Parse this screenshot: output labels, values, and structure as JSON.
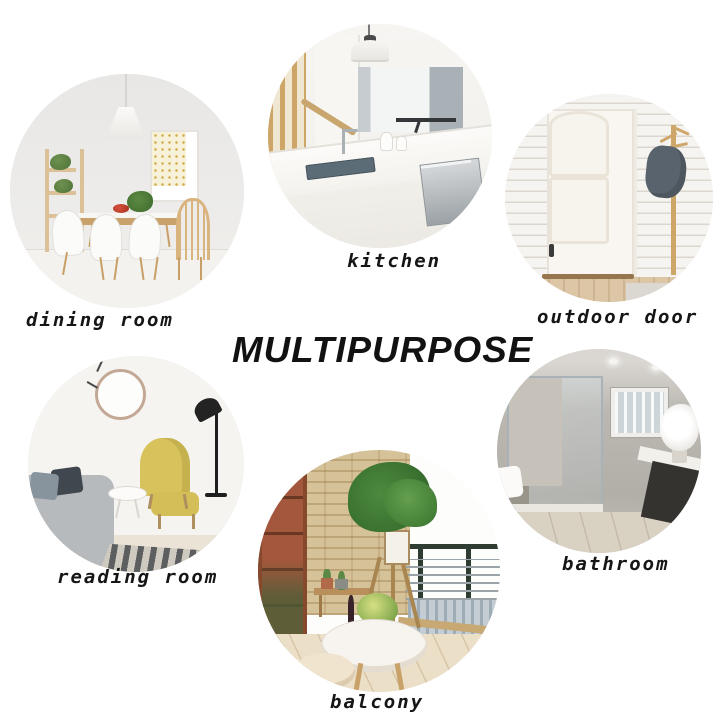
{
  "title": "MULTIPURPOSE",
  "rooms": [
    {
      "label": "dining room"
    },
    {
      "label": "kitchen"
    },
    {
      "label": "outdoor door"
    },
    {
      "label": "reading room"
    },
    {
      "label": "balcony"
    },
    {
      "label": "bathroom"
    }
  ],
  "colors": {
    "background": "#ffffff",
    "text": "#161616",
    "wood": "#c9a26b",
    "gold_art": "#d2ae4e",
    "yellow_chair": "#d7c25b",
    "stone_wall": "#d6c298",
    "brick": "#a3573c",
    "plant_green": "#4d8a3f",
    "jacket_gray": "#59636d",
    "bath_wall_gray": "#b2aea8",
    "railing_green": "#2e3c32"
  }
}
